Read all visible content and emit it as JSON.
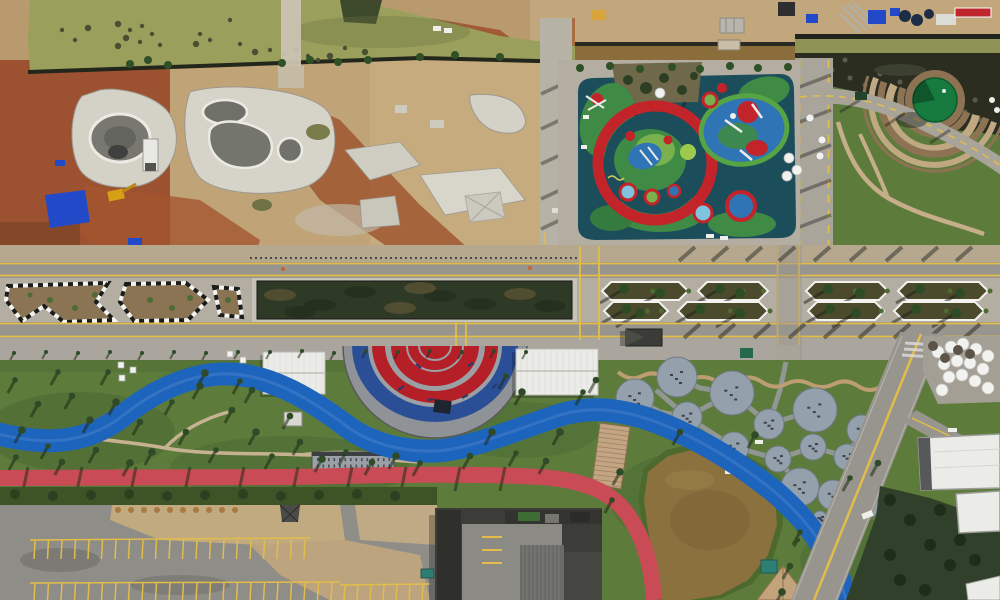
{
  "scene": {
    "type": "aerial-drone-photo",
    "description": "Top-down aerial view of an urban riverside park partly under construction: skate park earthworks and sediment pond (top left), colorful children playground (top center), terraced garden with round green canopy (top right), tree-lined boulevard with geometric planters crossing the middle, semicircular red/blue amphitheater, winding blue cycle path, red jogging track, fitness pod circles, muddy pond with boardwalk, parking lot and dark-roofed buildings along the bottom.",
    "landmarks": [
      "sediment-pond",
      "skate-park-construction",
      "drainage-canal",
      "materials-yard",
      "children-playground",
      "terraced-garden",
      "wetland-bank",
      "boulevard",
      "hedge-median",
      "striped-planters",
      "palm-planters",
      "amphitheater",
      "event-pavilions",
      "grandstand",
      "cycle-path",
      "jogging-track",
      "lawn",
      "fitness-pods",
      "boardwalk",
      "pond",
      "parking-lot",
      "warehouse-buildings",
      "diagonal-road",
      "umbrella-plaza",
      "office-buildings"
    ]
  },
  "colors": {
    "pond_water": "#9aa05c",
    "canal_water": "#8a6d3b",
    "wetland_dark": "#2a2d20",
    "dirt_red": "#9c5130",
    "dirt_tan": "#c2a77c",
    "concrete_light": "#d4d1c7",
    "concrete_mid": "#b3ada2",
    "road_asphalt": "#98948e",
    "sidewalk_tan": "#b5a88f",
    "line_yellow": "#e3bd4a",
    "hedge_dark": "#2f3a26",
    "planter_soil": "#8a7454",
    "planter_soil_dark": "#4c4a2c",
    "lawn_green": "#5d7c3c",
    "lawn_dark": "#466330",
    "tree_green": "#2f4a26",
    "playground_teal": "#1c4d5b",
    "playground_green": "#3f8a45",
    "playground_light": "#7ab14e",
    "playground_red": "#c3242a",
    "playground_blue": "#2f74b4",
    "amphi_red": "#b51f27",
    "amphi_blue": "#2b4f97",
    "amphi_gray": "#9aa0a4",
    "apron_gray": "#8f9297",
    "bike_blue": "#1d64bd",
    "track_red": "#c94b55",
    "pod_gray": "#94a0ac",
    "building_dark": "#3c3d39",
    "building_gray": "#8b8a84",
    "roof_white": "#ebebe8",
    "pond_brown": "#8a713e",
    "boardwalk_tan": "#c3a583",
    "tarp_blue": "#2149c8",
    "canopy_green": "#177a3e",
    "terrace_tan": "#c0a883",
    "terrace_brown": "#8d7354",
    "umbrella_white": "#f2f2f0"
  }
}
